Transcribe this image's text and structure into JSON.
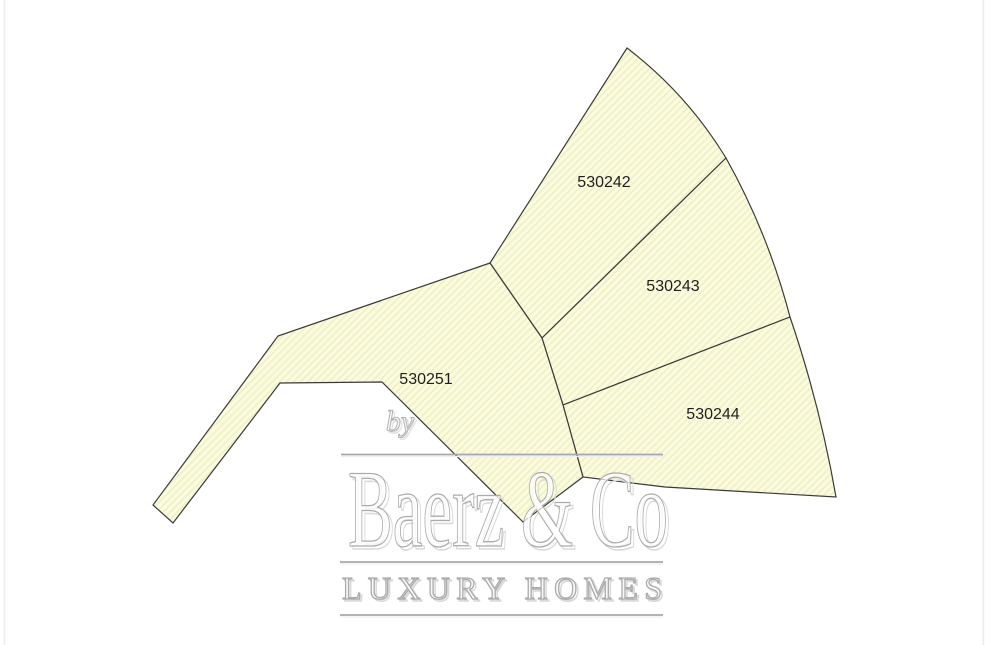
{
  "map": {
    "type": "cadastral-parcel-map",
    "background_color": "#ffffff",
    "parcel_fill_color": "#fbfbdf",
    "parcel_hatch_color": "#f0f0c6",
    "parcel_outline_color": "#3a3a3a",
    "label_color": "#1f1f1f",
    "parcels": [
      {
        "id": "530242",
        "label": "530242"
      },
      {
        "id": "530243",
        "label": "530243"
      },
      {
        "id": "530244",
        "label": "530244"
      },
      {
        "id": "530251",
        "label": "530251"
      }
    ]
  },
  "watermark": {
    "prefix": "by",
    "brand": "Baerz & Co",
    "tagline": "LUXURY HOMES",
    "text_color": "#ababab",
    "rule_color": "#a8a8a8"
  }
}
